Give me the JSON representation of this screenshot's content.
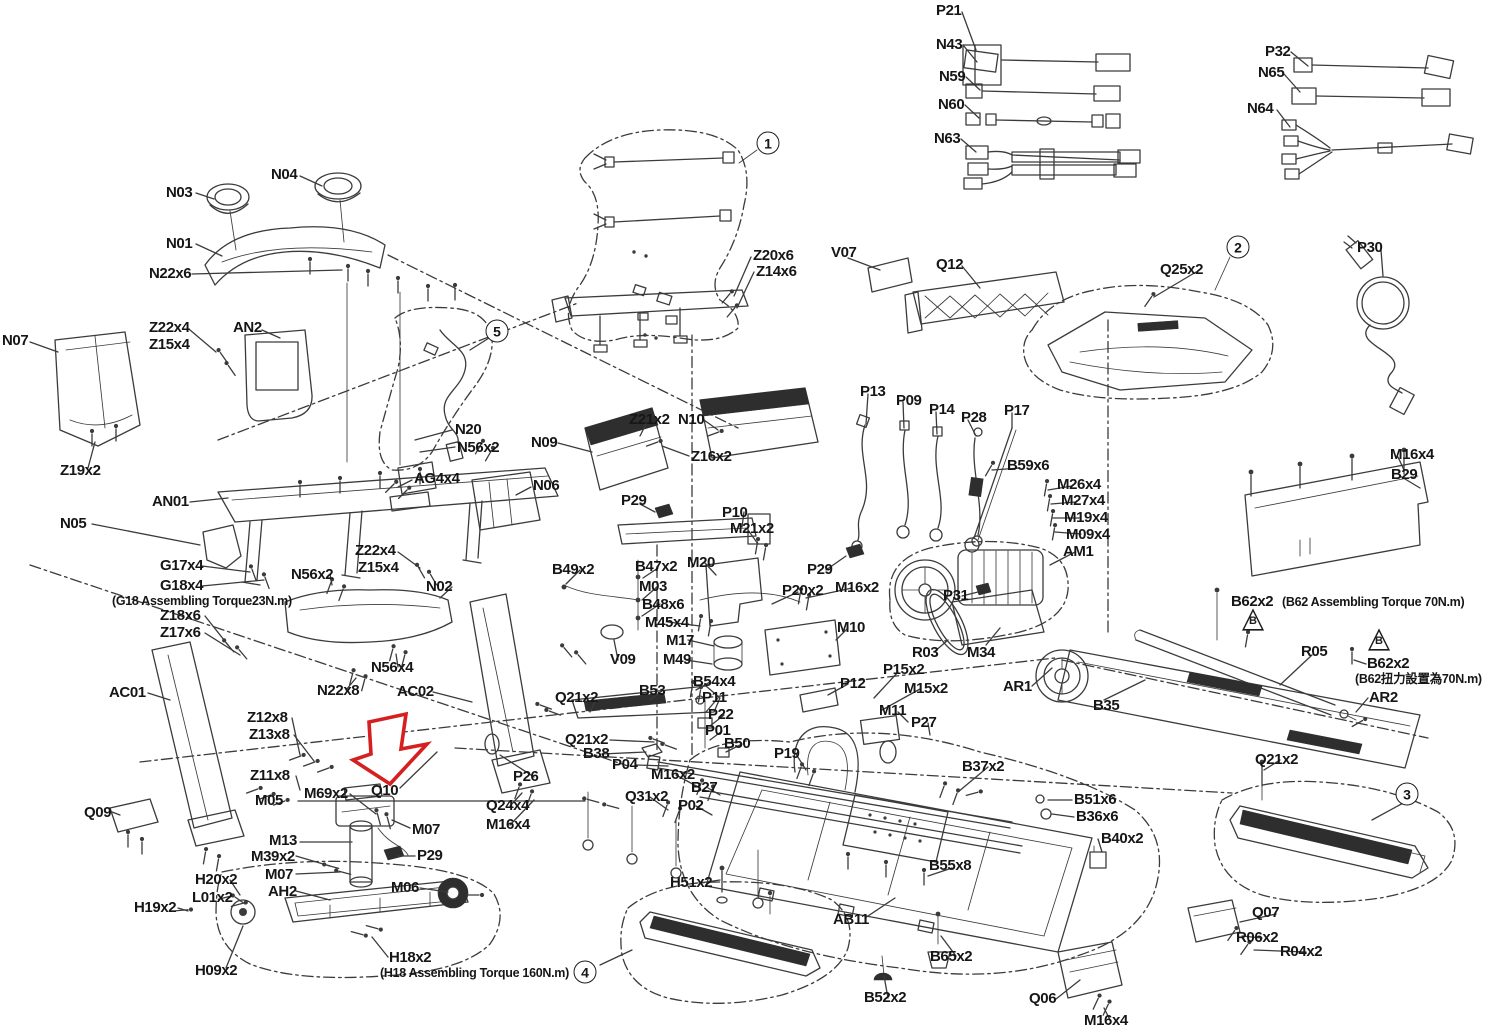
{
  "colors": {
    "line": "#3b3b3b",
    "background": "#ffffff",
    "highlight_arrow": "#d42020",
    "text": "#161616"
  },
  "labels": [
    {
      "text": "P21",
      "x": 936,
      "y": 3
    },
    {
      "text": "N43",
      "x": 936,
      "y": 37
    },
    {
      "text": "N59",
      "x": 939,
      "y": 69
    },
    {
      "text": "N60",
      "x": 938,
      "y": 97
    },
    {
      "text": "N63",
      "x": 934,
      "y": 131
    },
    {
      "text": "P32",
      "x": 1265,
      "y": 44
    },
    {
      "text": "N65",
      "x": 1258,
      "y": 65
    },
    {
      "text": "N64",
      "x": 1247,
      "y": 101
    },
    {
      "text": "P30",
      "x": 1357,
      "y": 240
    },
    {
      "text": "N03",
      "x": 166,
      "y": 185
    },
    {
      "text": "N04",
      "x": 271,
      "y": 167
    },
    {
      "text": "N01",
      "x": 166,
      "y": 236
    },
    {
      "text": "N22x6",
      "x": 149,
      "y": 266
    },
    {
      "text": "Z22x4",
      "x": 149,
      "y": 320
    },
    {
      "text": "Z15x4",
      "x": 149,
      "y": 337
    },
    {
      "text": "AN2",
      "x": 233,
      "y": 320
    },
    {
      "text": "N07",
      "x": 2,
      "y": 333
    },
    {
      "text": "Z19x2",
      "x": 60,
      "y": 463
    },
    {
      "text": "Z20x6",
      "x": 753,
      "y": 248
    },
    {
      "text": "Z14x6",
      "x": 756,
      "y": 264
    },
    {
      "text": "V07",
      "x": 831,
      "y": 245
    },
    {
      "text": "Q12",
      "x": 936,
      "y": 257
    },
    {
      "text": "Q25x2",
      "x": 1160,
      "y": 262
    },
    {
      "text": "N20",
      "x": 455,
      "y": 422
    },
    {
      "text": "N56x2",
      "x": 457,
      "y": 440
    },
    {
      "text": "AG4x4",
      "x": 414,
      "y": 471
    },
    {
      "text": "N06",
      "x": 533,
      "y": 478
    },
    {
      "text": "N09",
      "x": 531,
      "y": 435
    },
    {
      "text": "Z21x2",
      "x": 629,
      "y": 412
    },
    {
      "text": "N10",
      "x": 678,
      "y": 412
    },
    {
      "text": "Z16x2",
      "x": 691,
      "y": 449
    },
    {
      "text": "P29",
      "x": 621,
      "y": 493
    },
    {
      "text": "P10",
      "x": 722,
      "y": 505
    },
    {
      "text": "M21x2",
      "x": 730,
      "y": 521
    },
    {
      "text": "M20",
      "x": 687,
      "y": 555
    },
    {
      "text": "P13",
      "x": 860,
      "y": 384
    },
    {
      "text": "P09",
      "x": 896,
      "y": 393
    },
    {
      "text": "P14",
      "x": 929,
      "y": 402
    },
    {
      "text": "P28",
      "x": 961,
      "y": 410
    },
    {
      "text": "P17",
      "x": 1004,
      "y": 403
    },
    {
      "text": "B59x6",
      "x": 1007,
      "y": 458
    },
    {
      "text": "M26x4",
      "x": 1057,
      "y": 477
    },
    {
      "text": "M27x4",
      "x": 1061,
      "y": 493
    },
    {
      "text": "M19x4",
      "x": 1064,
      "y": 510
    },
    {
      "text": "M09x4",
      "x": 1066,
      "y": 527
    },
    {
      "text": "AM1",
      "x": 1063,
      "y": 544
    },
    {
      "text": "M16x4",
      "x": 1390,
      "y": 447
    },
    {
      "text": "B29",
      "x": 1391,
      "y": 467
    },
    {
      "text": "B62x2",
      "x": 1231,
      "y": 594
    },
    {
      "text": "(B62 Assembling Torque 70N.m)",
      "x": 1282,
      "y": 596,
      "note": true
    },
    {
      "text": "R05",
      "x": 1301,
      "y": 644
    },
    {
      "text": "B62x2",
      "x": 1367,
      "y": 656
    },
    {
      "text": "(B62扭力設置為70N.m)",
      "x": 1355,
      "y": 673,
      "note": true
    },
    {
      "text": "AR2",
      "x": 1369,
      "y": 690
    },
    {
      "text": "N05",
      "x": 60,
      "y": 516
    },
    {
      "text": "AN01",
      "x": 152,
      "y": 494
    },
    {
      "text": "G17x4",
      "x": 160,
      "y": 558
    },
    {
      "text": "G18x4",
      "x": 160,
      "y": 578
    },
    {
      "text": "(G18 Assembling Torque23N.m)",
      "x": 112,
      "y": 595,
      "note": true
    },
    {
      "text": "Z18x6",
      "x": 160,
      "y": 608
    },
    {
      "text": "Z17x6",
      "x": 160,
      "y": 625
    },
    {
      "text": "N56x2",
      "x": 291,
      "y": 567
    },
    {
      "text": "Z22x4",
      "x": 355,
      "y": 543
    },
    {
      "text": "Z15x4",
      "x": 358,
      "y": 560
    },
    {
      "text": "N02",
      "x": 426,
      "y": 579
    },
    {
      "text": "N56x4",
      "x": 371,
      "y": 660
    },
    {
      "text": "N22x8",
      "x": 317,
      "y": 683
    },
    {
      "text": "AC01",
      "x": 109,
      "y": 685
    },
    {
      "text": "AC02",
      "x": 397,
      "y": 684
    },
    {
      "text": "B49x2",
      "x": 552,
      "y": 562
    },
    {
      "text": "B47x2",
      "x": 635,
      "y": 559
    },
    {
      "text": "M03",
      "x": 639,
      "y": 579
    },
    {
      "text": "B48x6",
      "x": 642,
      "y": 597
    },
    {
      "text": "M45x4",
      "x": 645,
      "y": 615
    },
    {
      "text": "M17",
      "x": 666,
      "y": 633
    },
    {
      "text": "M49",
      "x": 663,
      "y": 652
    },
    {
      "text": "V09",
      "x": 610,
      "y": 652
    },
    {
      "text": "P29",
      "x": 807,
      "y": 562
    },
    {
      "text": "P20x2",
      "x": 782,
      "y": 583
    },
    {
      "text": "M16x2",
      "x": 835,
      "y": 580
    },
    {
      "text": "M10",
      "x": 837,
      "y": 620
    },
    {
      "text": "P31",
      "x": 943,
      "y": 588
    },
    {
      "text": "R03",
      "x": 912,
      "y": 645
    },
    {
      "text": "M34",
      "x": 967,
      "y": 645
    },
    {
      "text": "AR1",
      "x": 1003,
      "y": 679
    },
    {
      "text": "B35",
      "x": 1093,
      "y": 698
    },
    {
      "text": "P12",
      "x": 840,
      "y": 676
    },
    {
      "text": "P15x2",
      "x": 883,
      "y": 662
    },
    {
      "text": "M15x2",
      "x": 904,
      "y": 681
    },
    {
      "text": "M11",
      "x": 879,
      "y": 703
    },
    {
      "text": "P27",
      "x": 911,
      "y": 715
    },
    {
      "text": "Z12x8",
      "x": 247,
      "y": 710
    },
    {
      "text": "Z13x8",
      "x": 249,
      "y": 727
    },
    {
      "text": "Z11x8",
      "x": 250,
      "y": 768
    },
    {
      "text": "M05",
      "x": 255,
      "y": 793
    },
    {
      "text": "M69x2",
      "x": 304,
      "y": 786
    },
    {
      "text": "Q10",
      "x": 371,
      "y": 783
    },
    {
      "text": "M07",
      "x": 412,
      "y": 822
    },
    {
      "text": "M13",
      "x": 269,
      "y": 833
    },
    {
      "text": "M39x2",
      "x": 251,
      "y": 849
    },
    {
      "text": "M07",
      "x": 265,
      "y": 867
    },
    {
      "text": "AH2",
      "x": 268,
      "y": 884
    },
    {
      "text": "P29",
      "x": 417,
      "y": 848
    },
    {
      "text": "M06",
      "x": 391,
      "y": 880
    },
    {
      "text": "H20x2",
      "x": 195,
      "y": 872
    },
    {
      "text": "L01x2",
      "x": 192,
      "y": 890
    },
    {
      "text": "H19x2",
      "x": 134,
      "y": 900
    },
    {
      "text": "H09x2",
      "x": 195,
      "y": 963
    },
    {
      "text": "Q09",
      "x": 84,
      "y": 805
    },
    {
      "text": "Q21x2",
      "x": 555,
      "y": 690
    },
    {
      "text": "B53",
      "x": 639,
      "y": 683
    },
    {
      "text": "B54x4",
      "x": 693,
      "y": 674
    },
    {
      "text": "P11",
      "x": 702,
      "y": 690
    },
    {
      "text": "P22",
      "x": 708,
      "y": 707
    },
    {
      "text": "P01",
      "x": 705,
      "y": 723
    },
    {
      "text": "B50",
      "x": 724,
      "y": 736
    },
    {
      "text": "Q21x2",
      "x": 565,
      "y": 732
    },
    {
      "text": "B38",
      "x": 583,
      "y": 746
    },
    {
      "text": "P04",
      "x": 612,
      "y": 757
    },
    {
      "text": "M16x2",
      "x": 651,
      "y": 767
    },
    {
      "text": "B27",
      "x": 691,
      "y": 780
    },
    {
      "text": "Q31x2",
      "x": 625,
      "y": 789
    },
    {
      "text": "P02",
      "x": 678,
      "y": 798
    },
    {
      "text": "P26",
      "x": 513,
      "y": 769
    },
    {
      "text": "Q24x4",
      "x": 486,
      "y": 798
    },
    {
      "text": "M16x4",
      "x": 486,
      "y": 817
    },
    {
      "text": "P19",
      "x": 774,
      "y": 746
    },
    {
      "text": "B37x2",
      "x": 962,
      "y": 759
    },
    {
      "text": "B51x6",
      "x": 1074,
      "y": 792
    },
    {
      "text": "B36x6",
      "x": 1076,
      "y": 809
    },
    {
      "text": "B40x2",
      "x": 1101,
      "y": 831
    },
    {
      "text": "B55x8",
      "x": 929,
      "y": 858
    },
    {
      "text": "AB11",
      "x": 833,
      "y": 912
    },
    {
      "text": "H51x2",
      "x": 670,
      "y": 875
    },
    {
      "text": "H18x2",
      "x": 389,
      "y": 950
    },
    {
      "text": "(H18 Assembling Torque 160N.m)",
      "x": 380,
      "y": 967,
      "note": true
    },
    {
      "text": "B65x2",
      "x": 930,
      "y": 949
    },
    {
      "text": "B52x2",
      "x": 864,
      "y": 990
    },
    {
      "text": "Q06",
      "x": 1029,
      "y": 991
    },
    {
      "text": "M16x4",
      "x": 1084,
      "y": 1013
    },
    {
      "text": "Q21x2",
      "x": 1255,
      "y": 752
    },
    {
      "text": "Q07",
      "x": 1252,
      "y": 905
    },
    {
      "text": "R06x2",
      "x": 1236,
      "y": 930
    },
    {
      "text": "R04x2",
      "x": 1280,
      "y": 944
    }
  ],
  "callouts": [
    {
      "num": "1",
      "x": 768,
      "y": 143
    },
    {
      "num": "2",
      "x": 1238,
      "y": 247
    },
    {
      "num": "3",
      "x": 1407,
      "y": 794
    },
    {
      "num": "4",
      "x": 585,
      "y": 972
    },
    {
      "num": "5",
      "x": 497,
      "y": 331
    }
  ],
  "warning_triangles": [
    {
      "letter": "B",
      "x": 1253,
      "y": 618
    },
    {
      "letter": "B",
      "x": 1379,
      "y": 638
    }
  ]
}
